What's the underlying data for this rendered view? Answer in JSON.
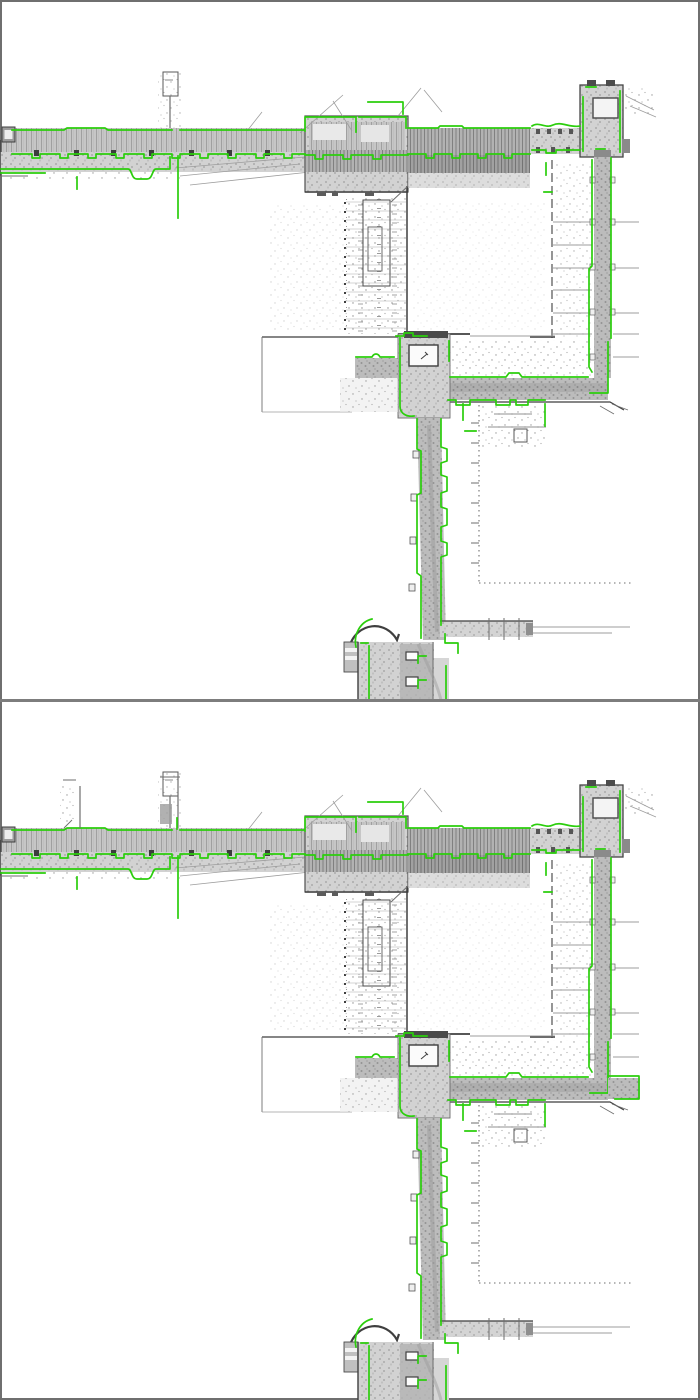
{
  "figure": {
    "name": "lidar-floorplan-comparison",
    "description": "Two stacked grayscale point-cloud floor-plan scans of the same building corridors, each overlaid with bright green extracted wall/outline contours. No text labels are visible.",
    "panel_count": 2,
    "panels": [
      {
        "name": "map-panel-top",
        "content": "point-cloud corridor map with green contour overlay"
      },
      {
        "name": "map-panel-bottom",
        "content": "point-cloud corridor map with green contour overlay (slightly different registration)"
      }
    ]
  },
  "palette": {
    "background": "#ffffff",
    "overlay_green": "#2bce0c",
    "wall_dark": "#3f3f3f",
    "wall_mid": "#6e6e6e",
    "pointcloud_gray": "#c6c6c6",
    "pointcloud_dark": "#b2b2b2",
    "pointcloud_light": "#e2e2e2",
    "frame": "#6f6f6f",
    "divider": "#7d7d7d"
  }
}
